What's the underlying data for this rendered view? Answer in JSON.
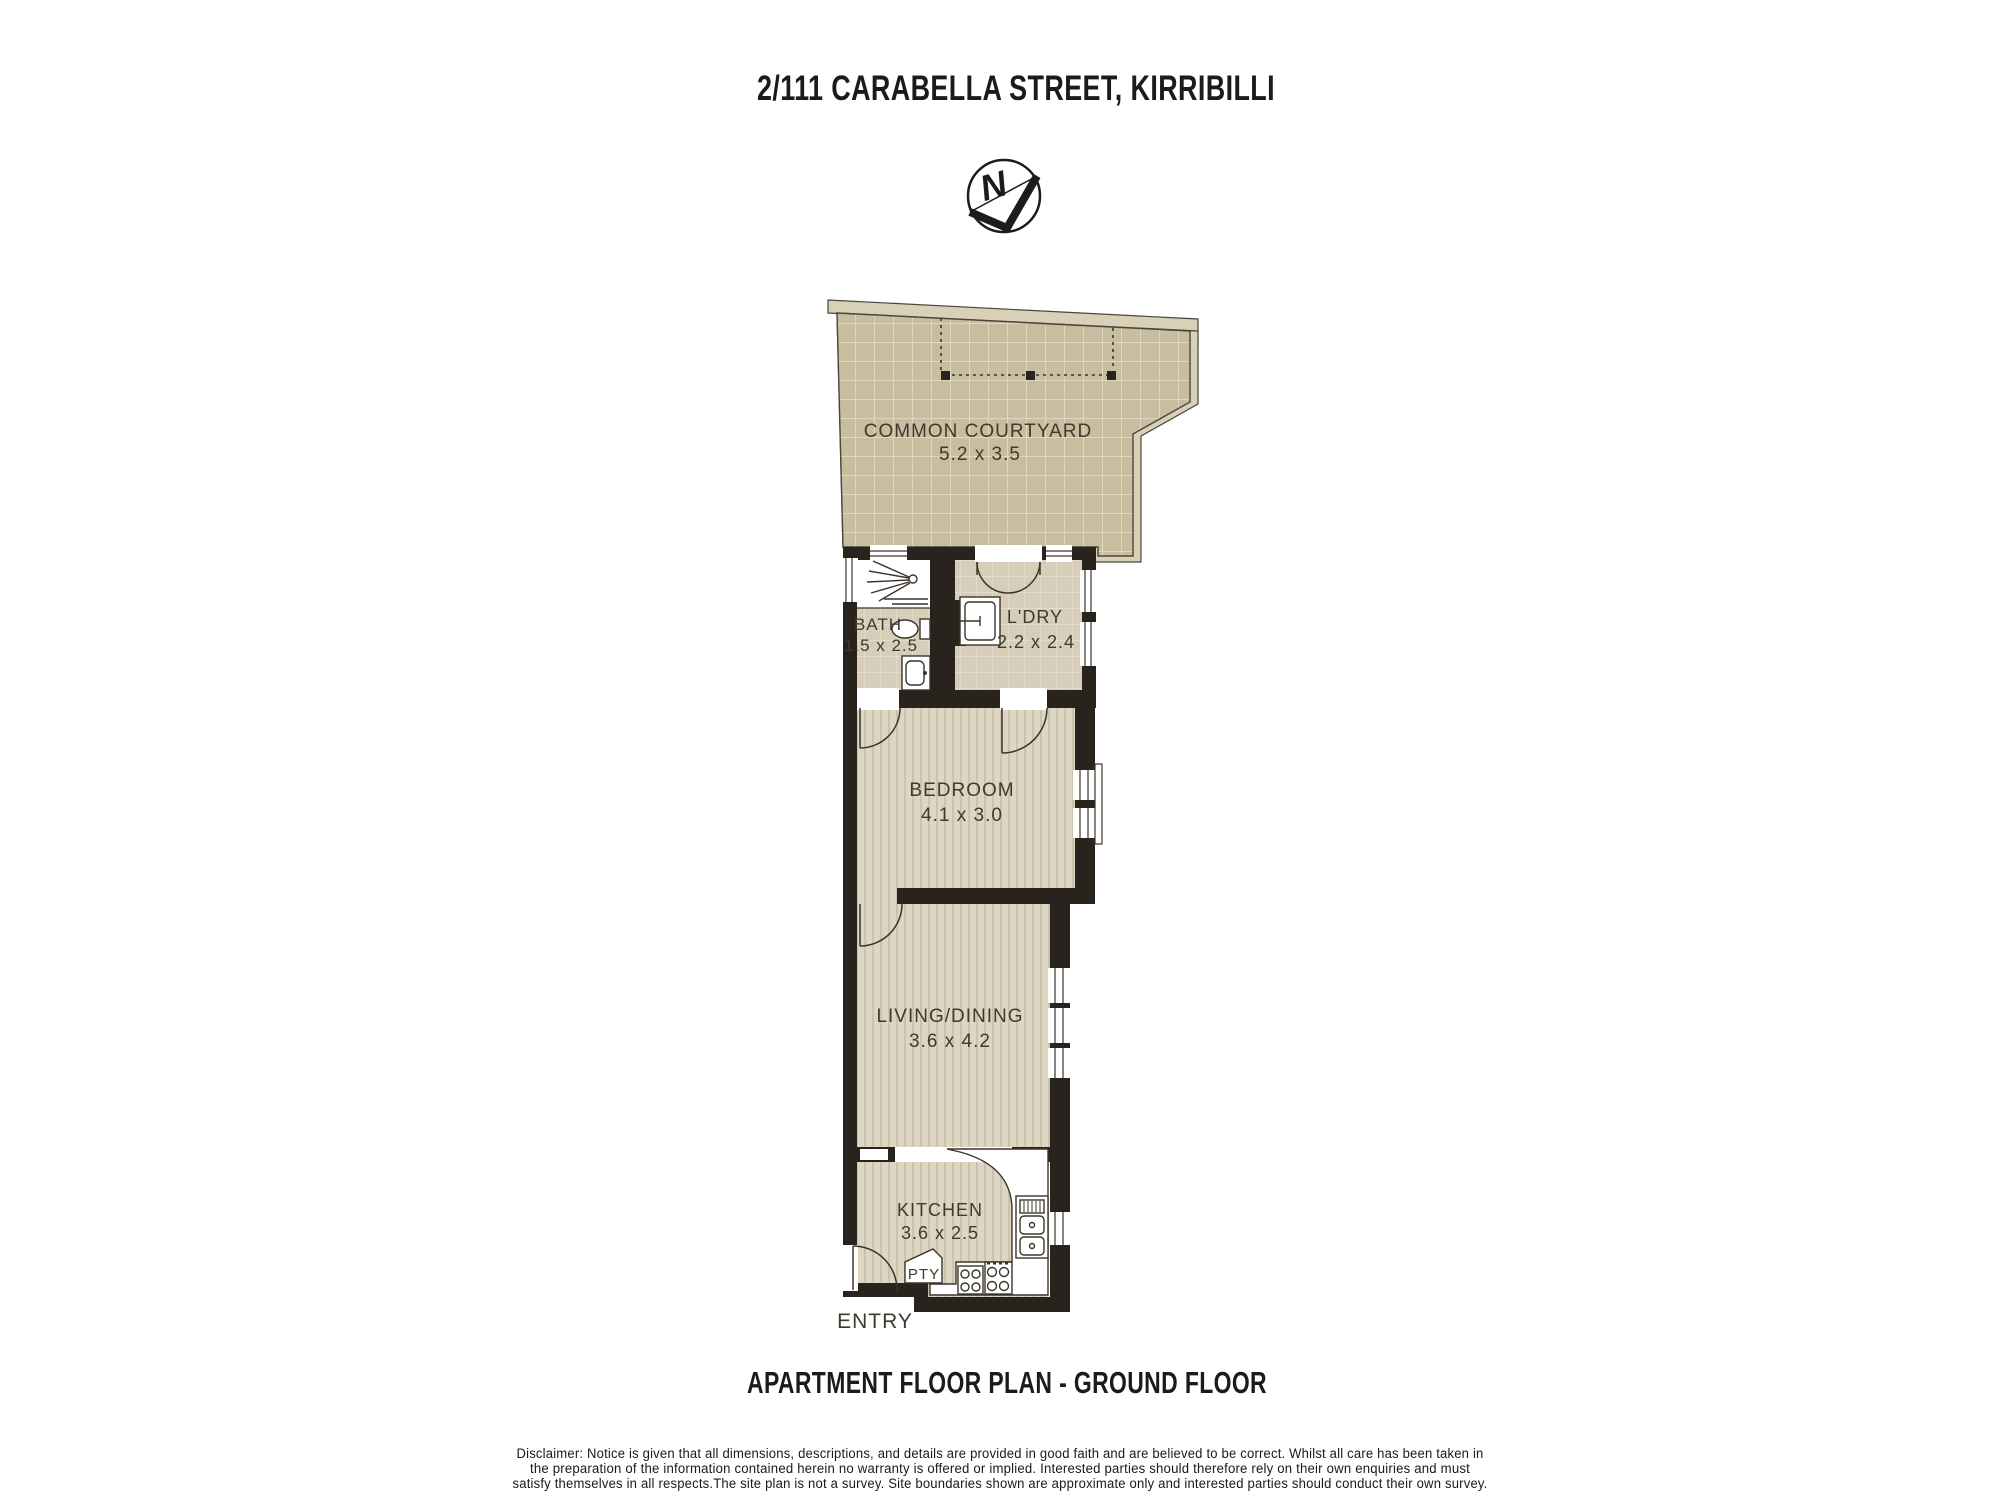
{
  "header": {
    "title": "2/111 CARABELLA STREET, KIRRIBILLI"
  },
  "compass": {
    "label": "N"
  },
  "plan": {
    "courtyard": {
      "name": "COMMON COURTYARD",
      "dims": "5.2 x 3.5"
    },
    "bath": {
      "name": "BATH",
      "dims": "1.5 x 2.5"
    },
    "laundry": {
      "name": "L'DRY",
      "dims": "2.2 x 2.4"
    },
    "bedroom": {
      "name": "BEDROOM",
      "dims": "4.1 x 3.0"
    },
    "living": {
      "name": "LIVING/DINING",
      "dims": "3.6 x 4.2"
    },
    "kitchen": {
      "name": "KITCHEN",
      "dims": "3.6 x 2.5"
    },
    "pantry": {
      "label": "PTY"
    },
    "entry": {
      "label": "ENTRY"
    }
  },
  "footer": {
    "title": "APARTMENT FLOOR PLAN - GROUND FLOOR"
  },
  "disclaimer": {
    "line1": "Disclaimer: Notice is given that all dimensions, descriptions, and details are provided in good faith and are believed to be correct. Whilst all care has been  taken in",
    "line2": "the preparation of the information contained herein no warranty is offered or implied. Interested parties should therefore rely on their own enquiries and must",
    "line3": "satisfy themselves in all respects.The site plan is not a survey. Site boundaries shown are approximate only and interested parties should conduct their own survey."
  },
  "colors": {
    "wall": "#29231e",
    "outline": "#3a352c",
    "fence": "#d9d0b8",
    "courtyard_tile": "#c9bda0",
    "courtyard_grid": "#e7e0cc",
    "indoor_tile": "#d7cdb8",
    "indoor_tile_grid": "#eae4d4",
    "floor_base": "#ddd6c3",
    "floor_stripe": "#ccc3ad",
    "label_text": "#3e3a2f",
    "title_text": "#1b1b19"
  }
}
